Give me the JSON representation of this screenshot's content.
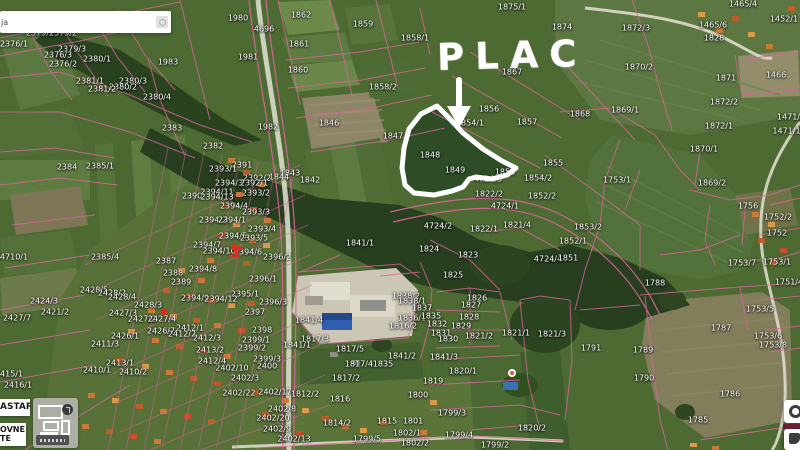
{
  "app": {
    "type": "cadastral-map-viewer"
  },
  "search": {
    "visible_text": "ja"
  },
  "annotation": {
    "label": "PLAC"
  },
  "layer_panel": {
    "button1_label": "ASTAR",
    "button2_line1": "OVNE",
    "button2_line2": "TE"
  },
  "colors": {
    "parcel_line": "#d9669b",
    "annotation_white": "#ffffff",
    "label_text": "#ffffff",
    "marker_red": "#d93025"
  },
  "parcels": [
    {
      "t": "2379/1",
      "x": 40,
      "y": 33
    },
    {
      "t": "2379/2",
      "x": 63,
      "y": 33
    },
    {
      "t": "2376/1",
      "x": 14,
      "y": 44
    },
    {
      "t": "2379/3",
      "x": 72,
      "y": 49
    },
    {
      "t": "2376/3",
      "x": 58,
      "y": 55
    },
    {
      "t": "2376/2",
      "x": 63,
      "y": 64
    },
    {
      "t": "2380/1",
      "x": 97,
      "y": 59
    },
    {
      "t": "1983",
      "x": 168,
      "y": 62
    },
    {
      "t": "2381/1",
      "x": 90,
      "y": 81
    },
    {
      "t": "2380/3",
      "x": 133,
      "y": 81
    },
    {
      "t": "2380/2",
      "x": 123,
      "y": 87
    },
    {
      "t": "2381/2",
      "x": 102,
      "y": 89
    },
    {
      "t": "2380/4",
      "x": 157,
      "y": 97
    },
    {
      "t": "2383",
      "x": 172,
      "y": 128
    },
    {
      "t": "2384",
      "x": 67,
      "y": 167
    },
    {
      "t": "2385/1",
      "x": 100,
      "y": 166
    },
    {
      "t": "2385/4",
      "x": 105,
      "y": 257
    },
    {
      "t": "4710/1",
      "x": 14,
      "y": 257
    },
    {
      "t": "2424/3",
      "x": 44,
      "y": 301
    },
    {
      "t": "2421/2",
      "x": 55,
      "y": 312
    },
    {
      "t": "2427/7",
      "x": 17,
      "y": 318
    },
    {
      "t": "2411/3",
      "x": 105,
      "y": 344
    },
    {
      "t": "2415/1",
      "x": 9,
      "y": 374
    },
    {
      "t": "2410/1",
      "x": 97,
      "y": 370
    },
    {
      "t": "2410/2",
      "x": 133,
      "y": 372
    },
    {
      "t": "2416/1",
      "x": 18,
      "y": 385
    },
    {
      "t": "2413/1",
      "x": 120,
      "y": 363
    },
    {
      "t": "2390",
      "x": 192,
      "y": 196
    },
    {
      "t": "2382",
      "x": 213,
      "y": 146
    },
    {
      "t": "1980",
      "x": 238,
      "y": 18
    },
    {
      "t": "4696",
      "x": 264,
      "y": 29
    },
    {
      "t": "1862",
      "x": 301,
      "y": 15
    },
    {
      "t": "1859",
      "x": 363,
      "y": 24
    },
    {
      "t": "1861",
      "x": 299,
      "y": 44
    },
    {
      "t": "1981",
      "x": 248,
      "y": 57
    },
    {
      "t": "1860",
      "x": 298,
      "y": 70
    },
    {
      "t": "1858/2",
      "x": 383,
      "y": 87
    },
    {
      "t": "1846",
      "x": 329,
      "y": 123
    },
    {
      "t": "1982",
      "x": 268,
      "y": 127
    },
    {
      "t": "1847",
      "x": 393,
      "y": 136
    },
    {
      "t": "1858/1",
      "x": 415,
      "y": 38
    },
    {
      "t": "1875/1",
      "x": 512,
      "y": 7
    },
    {
      "t": "1874",
      "x": 562,
      "y": 27
    },
    {
      "t": "1867",
      "x": 512,
      "y": 72
    },
    {
      "t": "1872/3",
      "x": 636,
      "y": 28
    },
    {
      "t": "1465/6",
      "x": 713,
      "y": 25
    },
    {
      "t": "1465/4",
      "x": 743,
      "y": 4
    },
    {
      "t": "1452/1",
      "x": 784,
      "y": 19
    },
    {
      "t": "1828",
      "x": 714,
      "y": 38
    },
    {
      "t": "1870/2",
      "x": 639,
      "y": 67
    },
    {
      "t": "1466",
      "x": 776,
      "y": 75
    },
    {
      "t": "1871",
      "x": 726,
      "y": 78
    },
    {
      "t": "1872/2",
      "x": 724,
      "y": 102
    },
    {
      "t": "1869/1",
      "x": 625,
      "y": 110
    },
    {
      "t": "1868",
      "x": 580,
      "y": 114
    },
    {
      "t": "1872/1",
      "x": 719,
      "y": 126
    },
    {
      "t": "1471/3",
      "x": 791,
      "y": 117
    },
    {
      "t": "1471/11",
      "x": 789,
      "y": 131
    },
    {
      "t": "1870/1",
      "x": 704,
      "y": 149
    },
    {
      "t": "1869/2",
      "x": 712,
      "y": 183
    },
    {
      "t": "1753/1",
      "x": 617,
      "y": 180
    },
    {
      "t": "1756",
      "x": 748,
      "y": 206
    },
    {
      "t": "1752/2",
      "x": 778,
      "y": 217
    },
    {
      "t": "1752",
      "x": 777,
      "y": 233
    },
    {
      "t": "1753/7",
      "x": 742,
      "y": 263
    },
    {
      "t": "1753/1",
      "x": 777,
      "y": 262
    },
    {
      "t": "1751/4",
      "x": 789,
      "y": 282
    },
    {
      "t": "1856",
      "x": 489,
      "y": 109
    },
    {
      "t": "1857",
      "x": 527,
      "y": 122
    },
    {
      "t": "1854/1",
      "x": 470,
      "y": 123
    },
    {
      "t": "1848",
      "x": 430,
      "y": 155
    },
    {
      "t": "1849",
      "x": 455,
      "y": 170
    },
    {
      "t": "1850",
      "x": 505,
      "y": 172
    },
    {
      "t": "1855",
      "x": 553,
      "y": 163
    },
    {
      "t": "4724/3",
      "x": 488,
      "y": 179
    },
    {
      "t": "1854/2",
      "x": 538,
      "y": 178
    },
    {
      "t": "1852/2",
      "x": 542,
      "y": 196
    },
    {
      "t": "1822/2",
      "x": 489,
      "y": 194
    },
    {
      "t": "4724/1",
      "x": 505,
      "y": 206
    },
    {
      "t": "1822/1",
      "x": 484,
      "y": 229
    },
    {
      "t": "1821/4",
      "x": 517,
      "y": 225
    },
    {
      "t": "1853/2",
      "x": 588,
      "y": 227
    },
    {
      "t": "1852/1",
      "x": 573,
      "y": 241
    },
    {
      "t": "4724/2",
      "x": 438,
      "y": 226
    },
    {
      "t": "1824",
      "x": 429,
      "y": 249
    },
    {
      "t": "1823",
      "x": 468,
      "y": 255
    },
    {
      "t": "4724/4",
      "x": 548,
      "y": 259
    },
    {
      "t": "1851",
      "x": 568,
      "y": 258
    },
    {
      "t": "1841/1",
      "x": 360,
      "y": 243
    },
    {
      "t": "1825",
      "x": 453,
      "y": 275
    },
    {
      "t": "1838/2",
      "x": 406,
      "y": 296
    },
    {
      "t": "1838/1",
      "x": 412,
      "y": 301
    },
    {
      "t": "1837",
      "x": 422,
      "y": 308
    },
    {
      "t": "1836/1",
      "x": 412,
      "y": 318
    },
    {
      "t": "1816/2",
      "x": 403,
      "y": 326
    },
    {
      "t": "1826",
      "x": 477,
      "y": 298
    },
    {
      "t": "1827",
      "x": 471,
      "y": 305
    },
    {
      "t": "1828",
      "x": 469,
      "y": 317
    },
    {
      "t": "1829",
      "x": 461,
      "y": 326
    },
    {
      "t": "1832",
      "x": 437,
      "y": 324
    },
    {
      "t": "1831",
      "x": 441,
      "y": 333
    },
    {
      "t": "1830",
      "x": 448,
      "y": 339
    },
    {
      "t": "1835",
      "x": 431,
      "y": 316
    },
    {
      "t": "1835",
      "x": 383,
      "y": 364
    },
    {
      "t": "1841/4",
      "x": 309,
      "y": 320
    },
    {
      "t": "1817/3",
      "x": 315,
      "y": 339
    },
    {
      "t": "1841/1",
      "x": 297,
      "y": 345
    },
    {
      "t": "1817/5",
      "x": 350,
      "y": 349
    },
    {
      "t": "1817/4",
      "x": 359,
      "y": 364
    },
    {
      "t": "1817/2",
      "x": 346,
      "y": 378
    },
    {
      "t": "1841/2",
      "x": 402,
      "y": 356
    },
    {
      "t": "1821/2",
      "x": 479,
      "y": 336
    },
    {
      "t": "1821/1",
      "x": 516,
      "y": 333
    },
    {
      "t": "1821/3",
      "x": 552,
      "y": 334
    },
    {
      "t": "1791",
      "x": 591,
      "y": 348
    },
    {
      "t": "1841/3",
      "x": 444,
      "y": 357
    },
    {
      "t": "1820/1",
      "x": 463,
      "y": 371
    },
    {
      "t": "1819",
      "x": 433,
      "y": 381
    },
    {
      "t": "1799/3",
      "x": 452,
      "y": 413
    },
    {
      "t": "1799/4",
      "x": 459,
      "y": 435
    },
    {
      "t": "1820/2",
      "x": 532,
      "y": 428
    },
    {
      "t": "1799/2",
      "x": 495,
      "y": 445
    },
    {
      "t": "1788",
      "x": 655,
      "y": 283
    },
    {
      "t": "1753/5",
      "x": 760,
      "y": 309
    },
    {
      "t": "1787",
      "x": 721,
      "y": 328
    },
    {
      "t": "1753/6",
      "x": 768,
      "y": 336
    },
    {
      "t": "1753/8",
      "x": 773,
      "y": 345
    },
    {
      "t": "1789",
      "x": 643,
      "y": 350
    },
    {
      "t": "1790",
      "x": 644,
      "y": 378
    },
    {
      "t": "1786",
      "x": 730,
      "y": 394
    },
    {
      "t": "1785",
      "x": 698,
      "y": 420
    },
    {
      "t": "2402/22",
      "x": 239,
      "y": 393
    },
    {
      "t": "2402/17",
      "x": 275,
      "y": 392
    },
    {
      "t": "1812/2",
      "x": 305,
      "y": 394
    },
    {
      "t": "1816",
      "x": 340,
      "y": 399
    },
    {
      "t": "1800",
      "x": 418,
      "y": 395
    },
    {
      "t": "2402/8",
      "x": 282,
      "y": 409
    },
    {
      "t": "2402/20",
      "x": 273,
      "y": 418
    },
    {
      "t": "1814/2",
      "x": 337,
      "y": 423
    },
    {
      "t": "1815",
      "x": 387,
      "y": 421
    },
    {
      "t": "1801",
      "x": 413,
      "y": 421
    },
    {
      "t": "2402/9",
      "x": 277,
      "y": 429
    },
    {
      "t": "2402/13",
      "x": 294,
      "y": 439
    },
    {
      "t": "1799/5",
      "x": 367,
      "y": 439
    },
    {
      "t": "1802/1",
      "x": 407,
      "y": 433
    },
    {
      "t": "1802/2",
      "x": 415,
      "y": 443
    },
    {
      "t": "2391",
      "x": 242,
      "y": 165
    },
    {
      "t": "2393/1",
      "x": 223,
      "y": 169
    },
    {
      "t": "1843",
      "x": 290,
      "y": 173
    },
    {
      "t": "1844",
      "x": 279,
      "y": 177
    },
    {
      "t": "1842",
      "x": 310,
      "y": 180
    },
    {
      "t": "2392/2",
      "x": 257,
      "y": 178
    },
    {
      "t": "2394/3",
      "x": 229,
      "y": 183
    },
    {
      "t": "2392/1",
      "x": 254,
      "y": 183
    },
    {
      "t": "2394/11",
      "x": 217,
      "y": 192
    },
    {
      "t": "2393/2",
      "x": 256,
      "y": 193
    },
    {
      "t": "2394/13",
      "x": 217,
      "y": 197
    },
    {
      "t": "2394/4",
      "x": 234,
      "y": 206
    },
    {
      "t": "2393/3",
      "x": 256,
      "y": 212
    },
    {
      "t": "2394/2",
      "x": 213,
      "y": 220
    },
    {
      "t": "2394/1",
      "x": 232,
      "y": 220
    },
    {
      "t": "2393/4",
      "x": 262,
      "y": 229
    },
    {
      "t": "2394/5",
      "x": 233,
      "y": 236
    },
    {
      "t": "2393/5",
      "x": 254,
      "y": 238
    },
    {
      "t": "2394/7",
      "x": 207,
      "y": 245
    },
    {
      "t": "2394/10",
      "x": 219,
      "y": 251
    },
    {
      "t": "2394/6",
      "x": 248,
      "y": 252
    },
    {
      "t": "2396/2",
      "x": 277,
      "y": 257
    },
    {
      "t": "2396/1",
      "x": 263,
      "y": 279
    },
    {
      "t": "2395/1",
      "x": 245,
      "y": 294
    },
    {
      "t": "2396/3",
      "x": 273,
      "y": 302
    },
    {
      "t": "2397",
      "x": 255,
      "y": 312
    },
    {
      "t": "2398",
      "x": 262,
      "y": 330
    },
    {
      "t": "2399/1",
      "x": 256,
      "y": 340
    },
    {
      "t": "2399/2",
      "x": 252,
      "y": 348
    },
    {
      "t": "2399/3",
      "x": 267,
      "y": 359
    },
    {
      "t": "2400",
      "x": 267,
      "y": 366
    },
    {
      "t": "2402/10",
      "x": 232,
      "y": 368
    },
    {
      "t": "2402/3",
      "x": 245,
      "y": 378
    },
    {
      "t": "2387",
      "x": 166,
      "y": 261
    },
    {
      "t": "2388",
      "x": 173,
      "y": 273
    },
    {
      "t": "2394/8",
      "x": 203,
      "y": 269
    },
    {
      "t": "2389",
      "x": 181,
      "y": 282
    },
    {
      "t": "2428/5",
      "x": 94,
      "y": 290
    },
    {
      "t": "2428/2",
      "x": 112,
      "y": 293
    },
    {
      "t": "2428/4",
      "x": 122,
      "y": 297
    },
    {
      "t": "2394/9",
      "x": 195,
      "y": 298
    },
    {
      "t": "2394/12",
      "x": 221,
      "y": 299
    },
    {
      "t": "2428/3",
      "x": 148,
      "y": 305
    },
    {
      "t": "2427/3",
      "x": 123,
      "y": 313
    },
    {
      "t": "2427/2",
      "x": 142,
      "y": 319
    },
    {
      "t": "2427/4",
      "x": 162,
      "y": 319
    },
    {
      "t": "2426/7",
      "x": 161,
      "y": 331
    },
    {
      "t": "2412/1",
      "x": 190,
      "y": 328
    },
    {
      "t": "2412/2",
      "x": 182,
      "y": 334
    },
    {
      "t": "2426/1",
      "x": 125,
      "y": 336
    },
    {
      "t": "2412/3",
      "x": 207,
      "y": 338
    },
    {
      "t": "2413/2",
      "x": 210,
      "y": 350
    },
    {
      "t": "2412/4",
      "x": 212,
      "y": 361
    }
  ]
}
